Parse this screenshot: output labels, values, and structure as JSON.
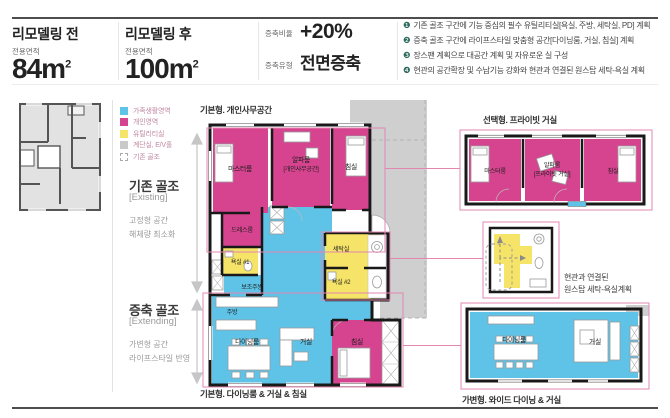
{
  "header": {
    "before": {
      "title": "리모델링 전",
      "area_label": "전용면적",
      "value": "84",
      "unit": "m",
      "sup": "2"
    },
    "after": {
      "title": "리모델링 후",
      "area_label": "전용면적",
      "value": "100",
      "unit": "m",
      "sup": "2"
    },
    "ratio": {
      "label": "증축비율",
      "value": "+20%"
    },
    "ext_type": {
      "label": "증축유형",
      "value": "전면증축"
    },
    "notes": [
      {
        "num": "❶",
        "text": "기존 골조 구간에 기능 중심의 필수 유틸리티실[욕실, 주방, 세탁실, PD] 계획"
      },
      {
        "num": "❷",
        "text": "증축 골조 구간에 라이프스타일 맞춤형 공간[다이닝룸, 거실, 침실] 계획"
      },
      {
        "num": "❸",
        "text": "장스팬 계획으로 대공간 계획 및 자유로운 실 구성"
      },
      {
        "num": "❹",
        "text": "현관의 공간확장 및 수납기능 강화와 현관과 연결된 원스탑 세탁-욕실 계획"
      }
    ]
  },
  "legend": {
    "items": [
      {
        "label": "가족생활영역",
        "color": "#5fc3e8"
      },
      {
        "label": "개인영역",
        "color": "#d6448f"
      },
      {
        "label": "유틸리티실",
        "color": "#f6e468"
      },
      {
        "label": "계단실, E/V홀",
        "color": "#c9c9c9"
      },
      {
        "label": "기존 골조",
        "color": "dashed-outline"
      }
    ]
  },
  "sidebar": {
    "existing": {
      "title": "기존 골조",
      "subtitle": "[Existing]",
      "line1": "고정형 공간",
      "line2": "해체량 최소화"
    },
    "extending": {
      "title": "증축 골조",
      "subtitle": "[Extending]",
      "line1": "가변형 공간",
      "line2": "라이프스타일 반영"
    }
  },
  "plans": {
    "main": {
      "title": "기본형. 개인사무공간",
      "caption": "기본형. 다이닝룸 & 거실 & 침실",
      "rooms": {
        "master": "마스터룸",
        "alpha1": "알파룸",
        "alpha2": "[개인사무공간]",
        "bedroom_top": "침실",
        "dress": "드레스룸",
        "bath1": "욕실 #1",
        "subkitchen": "보조주방",
        "laundry": "세탁실",
        "bath2": "욕실 #2",
        "kitchen": "주방",
        "dining": "다이닝룸",
        "living": "거실",
        "bedroom_bottom": "침실"
      }
    },
    "private": {
      "title": "선택형. 프라이빗 거실",
      "rooms": {
        "master": "마스터룸",
        "alpha1": "알파룸",
        "alpha2": "[프라이빗 거실]",
        "bedroom": "침실"
      }
    },
    "onestop": {
      "note1": "현관과 연결된",
      "note2": "원스탑 세탁-욕실계획"
    },
    "wide": {
      "caption": "가변형. 와이드 다이닝 & 거실",
      "rooms": {
        "dining": "다이닝룸",
        "living": "거실"
      }
    }
  },
  "colors": {
    "family": "#5fc3e8",
    "personal": "#d6448f",
    "utility": "#f6e468",
    "stair": "#c9c9c9",
    "annotation": "#e387b0"
  }
}
